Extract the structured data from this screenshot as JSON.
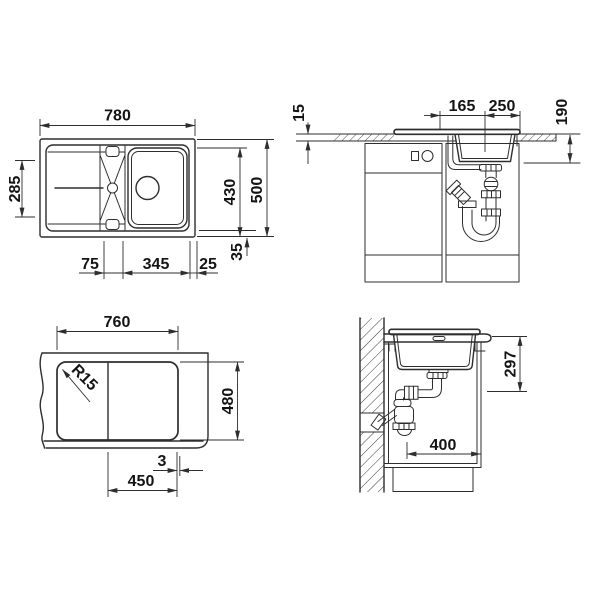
{
  "drawing": {
    "background": "#ffffff",
    "line_color": "#2e2e2e",
    "views": {
      "top_view": {
        "dims": {
          "overall_width": "780",
          "overall_depth": "500",
          "inner_depth": "430",
          "drainboard_depth": "285",
          "left_offset": "75",
          "bowl_width": "345",
          "right_offset": "25",
          "rim_width": "35"
        }
      },
      "front_view": {
        "dims": {
          "worktop_thickness": "15",
          "drain_offset": "165",
          "drain_to_edge": "250",
          "bowl_depth": "190"
        }
      },
      "cutout_view": {
        "dims": {
          "cutout_width": "760",
          "corner_radius": "R15",
          "cutout_depth": "480",
          "edge_gap": "3",
          "bowl_section_width": "450"
        }
      },
      "side_view": {
        "dims": {
          "depth_below_worktop": "297",
          "min_cabinet_depth": "400"
        }
      }
    }
  }
}
